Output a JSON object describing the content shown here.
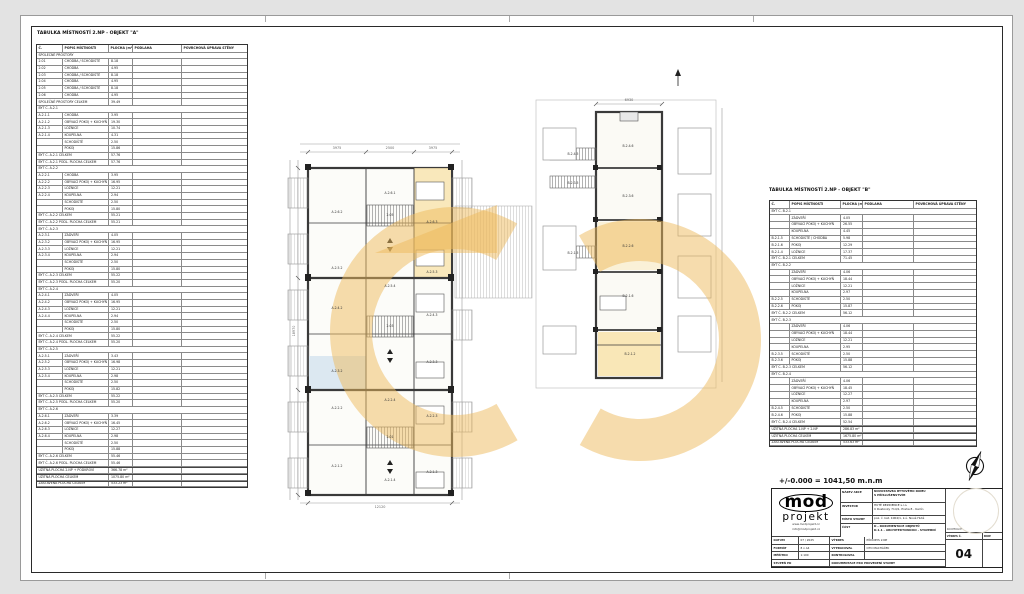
{
  "elevation_note": "+/-0.000 = 1041,50 m.n.m",
  "tables": {
    "a": {
      "title": "TABULKA MÍSTNOSTÍ 2.NP - OBJEKT \"A\"",
      "columns": [
        "Č.",
        "POPIS MÍSTNOSTI",
        "PLOCHA (m²)",
        "PODLAHA",
        "POVRCHOVÁ ÚPRAVA STĚNY"
      ],
      "widths": [
        26,
        46,
        24,
        49,
        65
      ],
      "row_height": 6.7,
      "rows": [
        {
          "t": "sec",
          "l": "SPOLEČNÉ PROSTORY"
        },
        {
          "t": "d",
          "c": "2.01",
          "p": "CHODBA / SCHODIŠTĚ",
          "a": "8.18"
        },
        {
          "t": "d",
          "c": "2.02",
          "p": "CHODBA",
          "a": "4.95"
        },
        {
          "t": "d",
          "c": "2.03",
          "p": "CHODBA / SCHODIŠTĚ",
          "a": "8.18"
        },
        {
          "t": "d",
          "c": "2.04",
          "p": "CHODBA",
          "a": "4.95"
        },
        {
          "t": "d",
          "c": "2.05",
          "p": "CHODBA / SCHODIŠTĚ",
          "a": "8.18"
        },
        {
          "t": "d",
          "c": "2.06",
          "p": "CHODBA",
          "a": "4.95"
        },
        {
          "t": "tot",
          "l": "SPOLEČNÉ PROSTORY CELKEM",
          "a": "39.49"
        },
        {
          "t": "sec",
          "l": "BYT Č. A.2.1"
        },
        {
          "t": "d",
          "c": "A.2.1.1",
          "p": "CHODBA",
          "a": "3.95"
        },
        {
          "t": "d",
          "c": "A.2.1.2",
          "p": "OBÝVACÍ POKOJ + KUCHYŇ",
          "a": "19.30"
        },
        {
          "t": "d",
          "c": "A.2.1.3",
          "p": "LOŽNICE",
          "a": "10.74"
        },
        {
          "t": "d",
          "c": "A.2.1.4",
          "p": "KOUPELNA",
          "a": "4.31"
        },
        {
          "t": "d",
          "c": "",
          "p": "SCHODIŠTĚ",
          "a": "2.50"
        },
        {
          "t": "d",
          "c": "",
          "p": "POKOJ",
          "a": "15.86"
        },
        {
          "t": "tot",
          "l": "BYT Č. A.2.1 CELKEM",
          "a": "57.76"
        },
        {
          "t": "tot",
          "l": "BYT Č. A.2.1 PODL. PLOCHA CELKEM",
          "a": "57.76"
        },
        {
          "t": "sec",
          "l": "BYT Č. A.2.2"
        },
        {
          "t": "d",
          "c": "A.2.2.1",
          "p": "CHODBA",
          "a": "3.95"
        },
        {
          "t": "d",
          "c": "A.2.2.2",
          "p": "OBÝVACÍ POKOJ + KUCHYŇ",
          "a": "16.95"
        },
        {
          "t": "d",
          "c": "A.2.2.3",
          "p": "LOŽNICE",
          "a": "12.21"
        },
        {
          "t": "d",
          "c": "A.2.2.4",
          "p": "KOUPELNA",
          "a": "2.94"
        },
        {
          "t": "d",
          "c": "",
          "p": "SCHODIŠTĚ",
          "a": "2.50"
        },
        {
          "t": "d",
          "c": "",
          "p": "POKOJ",
          "a": "15.80"
        },
        {
          "t": "tot",
          "l": "BYT Č. A.2.2 CELKEM",
          "a": "55.21"
        },
        {
          "t": "tot",
          "l": "BYT Č. A.2.2 PODL. PLOCHA CELKEM",
          "a": "55.21"
        },
        {
          "t": "sec",
          "l": "BYT Č. A.2.3"
        },
        {
          "t": "d",
          "c": "A.2.3.1",
          "p": "ZÁDVEŘÍ",
          "a": "4.05"
        },
        {
          "t": "d",
          "c": "A.2.3.2",
          "p": "OBÝVACÍ POKOJ + KUCHYŇ",
          "a": "16.95"
        },
        {
          "t": "d",
          "c": "A.2.3.3",
          "p": "LOŽNICE",
          "a": "12.21"
        },
        {
          "t": "d",
          "c": "A.2.3.4",
          "p": "KOUPELNA",
          "a": "2.94"
        },
        {
          "t": "d",
          "c": "",
          "p": "SCHODIŠTĚ",
          "a": "2.50"
        },
        {
          "t": "d",
          "c": "",
          "p": "POKOJ",
          "a": "15.80"
        },
        {
          "t": "tot",
          "l": "BYT Č. A.2.3 CELKEM",
          "a": "55.22"
        },
        {
          "t": "tot",
          "l": "BYT Č. A.2.3 PODL. PLOCHA CELKEM",
          "a": "55.20"
        },
        {
          "t": "sec",
          "l": "BYT Č. A.2.4"
        },
        {
          "t": "d",
          "c": "A.2.4.1",
          "p": "ZÁDVEŘÍ",
          "a": "4.05"
        },
        {
          "t": "d",
          "c": "A.2.4.2",
          "p": "OBÝVACÍ POKOJ + KUCHYŇ",
          "a": "16.95"
        },
        {
          "t": "d",
          "c": "A.2.4.3",
          "p": "LOŽNICE",
          "a": "12.21"
        },
        {
          "t": "d",
          "c": "A.2.4.4",
          "p": "KOUPELNA",
          "a": "2.94"
        },
        {
          "t": "d",
          "c": "",
          "p": "SCHODIŠTĚ",
          "a": "2.50"
        },
        {
          "t": "d",
          "c": "",
          "p": "POKOJ",
          "a": "15.80"
        },
        {
          "t": "tot",
          "l": "BYT Č. A.2.4 CELKEM",
          "a": "55.22"
        },
        {
          "t": "tot",
          "l": "BYT Č. A.2.4 PODL. PLOCHA CELKEM",
          "a": "55.20"
        },
        {
          "t": "sec",
          "l": "BYT Č. A.2.5"
        },
        {
          "t": "d",
          "c": "A.2.5.1",
          "p": "ZÁDVEŘÍ",
          "a": "3.43"
        },
        {
          "t": "d",
          "c": "A.2.5.2",
          "p": "OBÝVACÍ POKOJ + KUCHYŇ",
          "a": "16.98"
        },
        {
          "t": "d",
          "c": "A.2.5.3",
          "p": "LOŽNICE",
          "a": "12.21"
        },
        {
          "t": "d",
          "c": "A.2.5.4",
          "p": "KOUPELNA",
          "a": "2.98"
        },
        {
          "t": "d",
          "c": "",
          "p": "SCHODIŠTĚ",
          "a": "2.50"
        },
        {
          "t": "d",
          "c": "",
          "p": "POKOJ",
          "a": "15.82"
        },
        {
          "t": "tot",
          "l": "BYT Č. A.2.5 CELKEM",
          "a": "55.22"
        },
        {
          "t": "tot",
          "l": "BYT Č. A.2.5 PODL. PLOCHA CELKEM",
          "a": "55.20"
        },
        {
          "t": "sec",
          "l": "BYT Č. A.2.6"
        },
        {
          "t": "d",
          "c": "A.2.6.1",
          "p": "ZÁDVEŘÍ",
          "a": "3.39"
        },
        {
          "t": "d",
          "c": "A.2.6.2",
          "p": "OBÝVACÍ POKOJ + KUCHYŇ",
          "a": "16.45"
        },
        {
          "t": "d",
          "c": "A.2.6.3",
          "p": "LOŽNICE",
          "a": "12.27"
        },
        {
          "t": "d",
          "c": "A.2.6.4",
          "p": "KOUPELNA",
          "a": "2.98"
        },
        {
          "t": "d",
          "c": "",
          "p": "SCHODIŠTĚ",
          "a": "2.50"
        },
        {
          "t": "d",
          "c": "",
          "p": "POKOJ",
          "a": "15.88"
        },
        {
          "t": "tot",
          "l": "BYT Č. A.2.6 CELKEM",
          "a": "55.46"
        },
        {
          "t": "tot",
          "l": "BYT Č. A.2.6 PODL. PLOCHA CELKEM",
          "a": "55.46"
        },
        {
          "t": "sum",
          "l": "UŽITNÁ PLOCHA 2.NP + PODKROVÍ",
          "a": "366.78 m²"
        },
        {
          "t": "sum",
          "l": "UŽITNÁ PLOCHA CELKEM",
          "a": "1075.80 m²"
        },
        {
          "t": "sum",
          "l": "ZASTAVĚNÁ PLOCHA CELKEM",
          "a": "533.23 m²"
        }
      ]
    },
    "b": {
      "title": "TABULKA MÍSTNOSTÍ 2.NP - OBJEKT \"B\"",
      "columns": [
        "Č.",
        "POPIS MÍSTNOSTI",
        "PLOCHA (m²)",
        "PODLAHA",
        "POVRCHOVÁ ÚPRAVA STĚNY"
      ],
      "widths": [
        20,
        51,
        22,
        51,
        62
      ],
      "row_height": 6.8,
      "rows": [
        {
          "t": "sec",
          "l": "BYT Č. B.2.1"
        },
        {
          "t": "d",
          "c": "",
          "p": "ZÁDVEŘÍ",
          "a": "4.05"
        },
        {
          "t": "d",
          "c": "",
          "p": "OBÝVACÍ POKOJ + KUCHYŇ",
          "a": "26.55"
        },
        {
          "t": "d",
          "c": "",
          "p": "KOUPELNA",
          "a": "4.45"
        },
        {
          "t": "d",
          "c": "B.2.1.5",
          "p": "SCHODIŠTĚ / CHODBA",
          "a": "5.98"
        },
        {
          "t": "d",
          "c": "B.2.1.6",
          "p": "POKOJ",
          "a": "12.29"
        },
        {
          "t": "d",
          "c": "B.2.1.4",
          "p": "LOŽNICE",
          "a": "17.37"
        },
        {
          "t": "tot",
          "l": "BYT Č. B.2.1 CELKEM",
          "a": "71.45"
        },
        {
          "t": "sec",
          "l": "BYT Č. B.2.2"
        },
        {
          "t": "d",
          "c": "",
          "p": "ZÁDVEŘÍ",
          "a": "4.06"
        },
        {
          "t": "d",
          "c": "",
          "p": "OBÝVACÍ POKOJ + KUCHYŇ",
          "a": "18.44"
        },
        {
          "t": "d",
          "c": "",
          "p": "LOŽNICE",
          "a": "12.21"
        },
        {
          "t": "d",
          "c": "",
          "p": "KOUPELNA",
          "a": "2.97"
        },
        {
          "t": "d",
          "c": "B.2.2.5",
          "p": "SCHODIŠTĚ",
          "a": "2.50"
        },
        {
          "t": "d",
          "c": "B.2.2.6",
          "p": "POKOJ",
          "a": "15.87"
        },
        {
          "t": "tot",
          "l": "BYT Č. B.2.2 CELKEM",
          "a": "56.12"
        },
        {
          "t": "sec",
          "l": "BYT Č. B.2.3"
        },
        {
          "t": "d",
          "c": "",
          "p": "ZÁDVEŘÍ",
          "a": "4.06"
        },
        {
          "t": "d",
          "c": "",
          "p": "OBÝVACÍ POKOJ + KUCHYŇ",
          "a": "18.44"
        },
        {
          "t": "d",
          "c": "",
          "p": "LOŽNICE",
          "a": "12.21"
        },
        {
          "t": "d",
          "c": "",
          "p": "KOUPELNA",
          "a": "2.95"
        },
        {
          "t": "d",
          "c": "B.2.3.5",
          "p": "SCHODIŠTĚ",
          "a": "2.50"
        },
        {
          "t": "d",
          "c": "B.2.3.6",
          "p": "POKOJ",
          "a": "15.88"
        },
        {
          "t": "tot",
          "l": "BYT Č. B.2.3 CELKEM",
          "a": "56.12"
        },
        {
          "t": "sec",
          "l": "BYT Č. B.2.4"
        },
        {
          "t": "d",
          "c": "",
          "p": "ZÁDVEŘÍ",
          "a": "4.06"
        },
        {
          "t": "d",
          "c": "",
          "p": "OBÝVACÍ POKOJ + KUCHYŇ",
          "a": "18.45"
        },
        {
          "t": "d",
          "c": "",
          "p": "LOŽNICE",
          "a": "12.27"
        },
        {
          "t": "d",
          "c": "",
          "p": "KOUPELNA",
          "a": "2.97"
        },
        {
          "t": "d",
          "c": "B.2.4.5",
          "p": "SCHODIŠTĚ",
          "a": "2.50"
        },
        {
          "t": "d",
          "c": "B.2.4.6",
          "p": "POKOJ",
          "a": "15.88"
        },
        {
          "t": "tot",
          "l": "BYT Č. B.2.4 CELKEM",
          "a": "52.54"
        },
        {
          "t": "sum",
          "l": "UŽITNÁ PLOCHA 1.NP + 2.NP",
          "a": "286.83 m²"
        },
        {
          "t": "sum",
          "l": "UŽITNÁ PLOCHA CELKEM",
          "a": "1675.80 m²"
        },
        {
          "t": "sum",
          "l": "ZASTAVĚNÁ PLOCHA CELKEM",
          "a": "533.63 m²"
        }
      ]
    }
  },
  "plan": {
    "watermark_color": "#eeba5c",
    "a_labels": [
      {
        "t": "A.2.6.2",
        "x": 337,
        "y": 212
      },
      {
        "t": "A.2.6.1",
        "x": 390,
        "y": 193
      },
      {
        "t": "A.2.6.3",
        "x": 432,
        "y": 222
      },
      {
        "t": "2.05",
        "x": 390,
        "y": 215
      },
      {
        "t": "A.2.5.2",
        "x": 337,
        "y": 268
      },
      {
        "t": "A.2.5.4",
        "x": 390,
        "y": 286
      },
      {
        "t": "A.2.5.3",
        "x": 432,
        "y": 272
      },
      {
        "t": "A.2.4.2",
        "x": 337,
        "y": 308
      },
      {
        "t": "A.2.4.3",
        "x": 432,
        "y": 315
      },
      {
        "t": "2.03",
        "x": 390,
        "y": 326
      },
      {
        "t": "A.2.3.2",
        "x": 337,
        "y": 371
      },
      {
        "t": "A.2.3.3",
        "x": 432,
        "y": 362
      },
      {
        "t": "A.2.2.2",
        "x": 337,
        "y": 408
      },
      {
        "t": "A.2.2.4",
        "x": 390,
        "y": 400
      },
      {
        "t": "A.2.2.3",
        "x": 432,
        "y": 416
      },
      {
        "t": "2.01",
        "x": 390,
        "y": 437
      },
      {
        "t": "A.2.1.2",
        "x": 337,
        "y": 466
      },
      {
        "t": "A.2.1.4",
        "x": 390,
        "y": 480
      },
      {
        "t": "A.2.1.3",
        "x": 432,
        "y": 472
      }
    ],
    "b_labels": [
      {
        "t": "B.2.4.6",
        "x": 628,
        "y": 146
      },
      {
        "t": "B.2.4.5",
        "x": 573,
        "y": 154
      },
      {
        "t": "B.2.3.6",
        "x": 628,
        "y": 196
      },
      {
        "t": "B.2.3.5",
        "x": 573,
        "y": 183
      },
      {
        "t": "B.2.2.6",
        "x": 628,
        "y": 246
      },
      {
        "t": "B.2.1.5",
        "x": 573,
        "y": 253
      },
      {
        "t": "B.2.1.6",
        "x": 628,
        "y": 296
      },
      {
        "t": "B.2.1.2",
        "x": 630,
        "y": 354
      }
    ],
    "dims": [
      {
        "t": "3975",
        "x": 337,
        "y": 148
      },
      {
        "t": "2500",
        "x": 390,
        "y": 148
      },
      {
        "t": "3975",
        "x": 433,
        "y": 148
      },
      {
        "t": "12120",
        "x": 380,
        "y": 507
      },
      {
        "t": "18970",
        "x": 294,
        "y": 331,
        "r": 1
      },
      {
        "t": "6930",
        "x": 629,
        "y": 100
      }
    ]
  },
  "title_block": {
    "logo": {
      "name": "mod",
      "sub": "projekt",
      "web": "www.modprojekt.cz",
      "email": "info@modprojekt.cz"
    },
    "fields": [
      {
        "label": "NÁZEV AKCE",
        "value": "NOVOSTAVBA BYTOVÉHO DOMU\nS PŘÍSLUŠENSTVÍM"
      },
      {
        "label": "INVESTOR",
        "value": "HUTĚ REZIDENCE s.r.o.\nU Rustonky 714/1, Praha 8 - Karlín"
      },
      {
        "label": "MÍSTO STAVBY",
        "value": "poz. č. kat. 1004/1, k.ú. Nové Hutě"
      },
      {
        "label": "ČÁST",
        "value": "D - DOKUMENTACE OBJEKTŮ\nD.1.1 - ARCHITEKTONICKO - STAVEBNÍ"
      }
    ],
    "meta": [
      {
        "l1": "DATUM",
        "v1": "07 / 2025",
        "l2": "VÝKRES",
        "v2": "PŮDORYS 2.NP"
      },
      {
        "l1": "FORMÁT",
        "v1": "8 x A4",
        "l2": "VYPRACOVAL",
        "v2": "OTO MACHÁČEK"
      },
      {
        "l1": "MĚŘÍTKO",
        "v1": "1:100",
        "l2": "KONTROLOVAL",
        "v2": ""
      }
    ],
    "stupen_label": "STUPEŇ  PD",
    "stupen_value": "DOKUMENTACE PRO PROVEDENÍ STAVBY",
    "kooperace": "KOOPERACE",
    "vykres_c": "VÝKRES Č.",
    "pare": "PARE",
    "number": "04"
  }
}
